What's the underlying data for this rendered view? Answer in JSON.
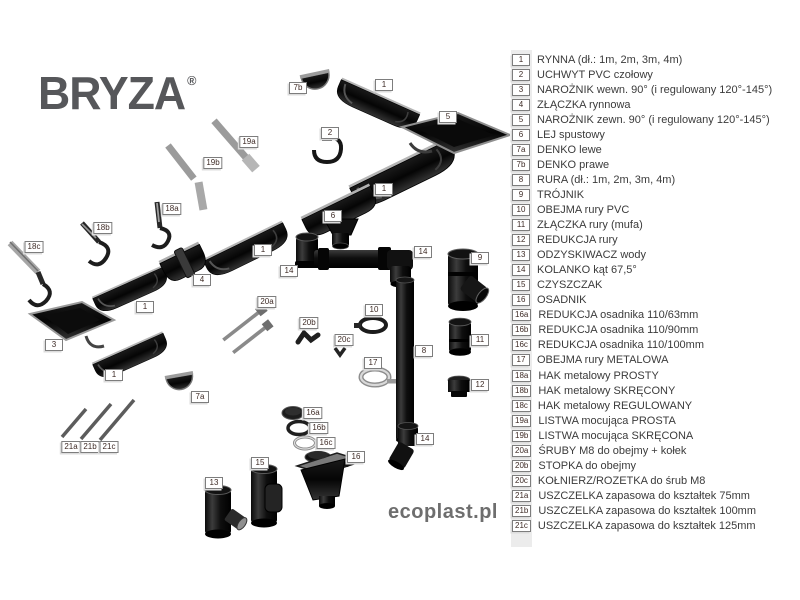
{
  "brand": {
    "logo": "BRYZA",
    "registered": "®",
    "website": "ecoplast.pl"
  },
  "colors": {
    "part_black": "#111111",
    "metal_gray": "#9b9b9b",
    "logo_gray": "#56575a",
    "legend_text": "#3b3b3b",
    "marker_text": "#3e2b26",
    "legend_band": "#ececec"
  },
  "legend": {
    "items": [
      {
        "id": "1",
        "label": "RYNNA (dł.: 1m, 2m, 3m, 4m)"
      },
      {
        "id": "2",
        "label": "UCHWYT PVC czołowy"
      },
      {
        "id": "3",
        "label": "NAROŻNIK wewn. 90° (i regulowany 120°-145°)"
      },
      {
        "id": "4",
        "label": "ZŁĄCZKA rynnowa"
      },
      {
        "id": "5",
        "label": "NAROŻNIK zewn. 90° (i regulowany 120°-145°)"
      },
      {
        "id": "6",
        "label": "LEJ spustowy"
      },
      {
        "id": "7a",
        "label": "DENKO lewe"
      },
      {
        "id": "7b",
        "label": "DENKO prawe"
      },
      {
        "id": "8",
        "label": "RURA (dł.: 1m, 2m, 3m, 4m)"
      },
      {
        "id": "9",
        "label": "TRÓJNIK"
      },
      {
        "id": "10",
        "label": "OBEJMA rury PVC"
      },
      {
        "id": "11",
        "label": "ZŁĄCZKA rury (mufa)"
      },
      {
        "id": "12",
        "label": "REDUKCJA rury"
      },
      {
        "id": "13",
        "label": "ODZYSKIWACZ wody"
      },
      {
        "id": "14",
        "label": "KOLANKO kąt 67,5°"
      },
      {
        "id": "15",
        "label": "CZYSZCZAK"
      },
      {
        "id": "16",
        "label": "OSADNIK"
      },
      {
        "id": "16a",
        "label": "REDUKCJA osadnika 110/63mm"
      },
      {
        "id": "16b",
        "label": "REDUKCJA osadnika 110/90mm"
      },
      {
        "id": "16c",
        "label": "REDUKCJA osadnika 110/100mm"
      },
      {
        "id": "17",
        "label": "OBEJMA rury METALOWA"
      },
      {
        "id": "18a",
        "label": "HAK metalowy PROSTY"
      },
      {
        "id": "18b",
        "label": "HAK metalowy SKRĘCONY"
      },
      {
        "id": "18c",
        "label": "HAK metalowy REGULOWANY"
      },
      {
        "id": "19a",
        "label": "LISTWA mocująca PROSTA"
      },
      {
        "id": "19b",
        "label": "LISTWA mocująca SKRĘCONA"
      },
      {
        "id": "20a",
        "label": "ŚRUBY M8 do obejmy + kołek"
      },
      {
        "id": "20b",
        "label": "STOPKA do obejmy"
      },
      {
        "id": "20c",
        "label": "KOŁNIERZ/ROZETKA do śrub M8"
      },
      {
        "id": "21a",
        "label": "USZCZELKA zapasowa do kształtek 75mm"
      },
      {
        "id": "21b",
        "label": "USZCZELKA zapasowa do kształtek 100mm"
      },
      {
        "id": "21c",
        "label": "USZCZELKA zapasowa do kształtek 125mm"
      }
    ]
  },
  "diagram": {
    "markers": [
      {
        "id": "7b",
        "x": 298,
        "y": 88
      },
      {
        "id": "1",
        "x": 384,
        "y": 85
      },
      {
        "id": "5",
        "x": 448,
        "y": 117
      },
      {
        "id": "2",
        "x": 330,
        "y": 133
      },
      {
        "id": "19a",
        "x": 249,
        "y": 142
      },
      {
        "id": "19b",
        "x": 213,
        "y": 163
      },
      {
        "id": "1",
        "x": 384,
        "y": 189
      },
      {
        "id": "18a",
        "x": 172,
        "y": 209
      },
      {
        "id": "6",
        "x": 333,
        "y": 216
      },
      {
        "id": "18b",
        "x": 103,
        "y": 228
      },
      {
        "id": "18c",
        "x": 34,
        "y": 247
      },
      {
        "id": "1",
        "x": 263,
        "y": 250
      },
      {
        "id": "14",
        "x": 423,
        "y": 252
      },
      {
        "id": "9",
        "x": 480,
        "y": 258
      },
      {
        "id": "14",
        "x": 289,
        "y": 271
      },
      {
        "id": "4",
        "x": 202,
        "y": 280
      },
      {
        "id": "20a",
        "x": 267,
        "y": 302
      },
      {
        "id": "1",
        "x": 145,
        "y": 307
      },
      {
        "id": "10",
        "x": 374,
        "y": 310
      },
      {
        "id": "20b",
        "x": 309,
        "y": 323
      },
      {
        "id": "20c",
        "x": 344,
        "y": 340
      },
      {
        "id": "11",
        "x": 480,
        "y": 340
      },
      {
        "id": "3",
        "x": 54,
        "y": 345
      },
      {
        "id": "8",
        "x": 424,
        "y": 351
      },
      {
        "id": "17",
        "x": 373,
        "y": 363
      },
      {
        "id": "1",
        "x": 114,
        "y": 375
      },
      {
        "id": "12",
        "x": 480,
        "y": 385
      },
      {
        "id": "7a",
        "x": 200,
        "y": 397
      },
      {
        "id": "16a",
        "x": 313,
        "y": 413
      },
      {
        "id": "16b",
        "x": 319,
        "y": 428
      },
      {
        "id": "14",
        "x": 425,
        "y": 439
      },
      {
        "id": "16c",
        "x": 326,
        "y": 443
      },
      {
        "id": "21a",
        "x": 71,
        "y": 447
      },
      {
        "id": "21b",
        "x": 90,
        "y": 447
      },
      {
        "id": "21c",
        "x": 109,
        "y": 447
      },
      {
        "id": "16",
        "x": 356,
        "y": 457
      },
      {
        "id": "15",
        "x": 260,
        "y": 463
      },
      {
        "id": "13",
        "x": 214,
        "y": 483
      }
    ]
  }
}
